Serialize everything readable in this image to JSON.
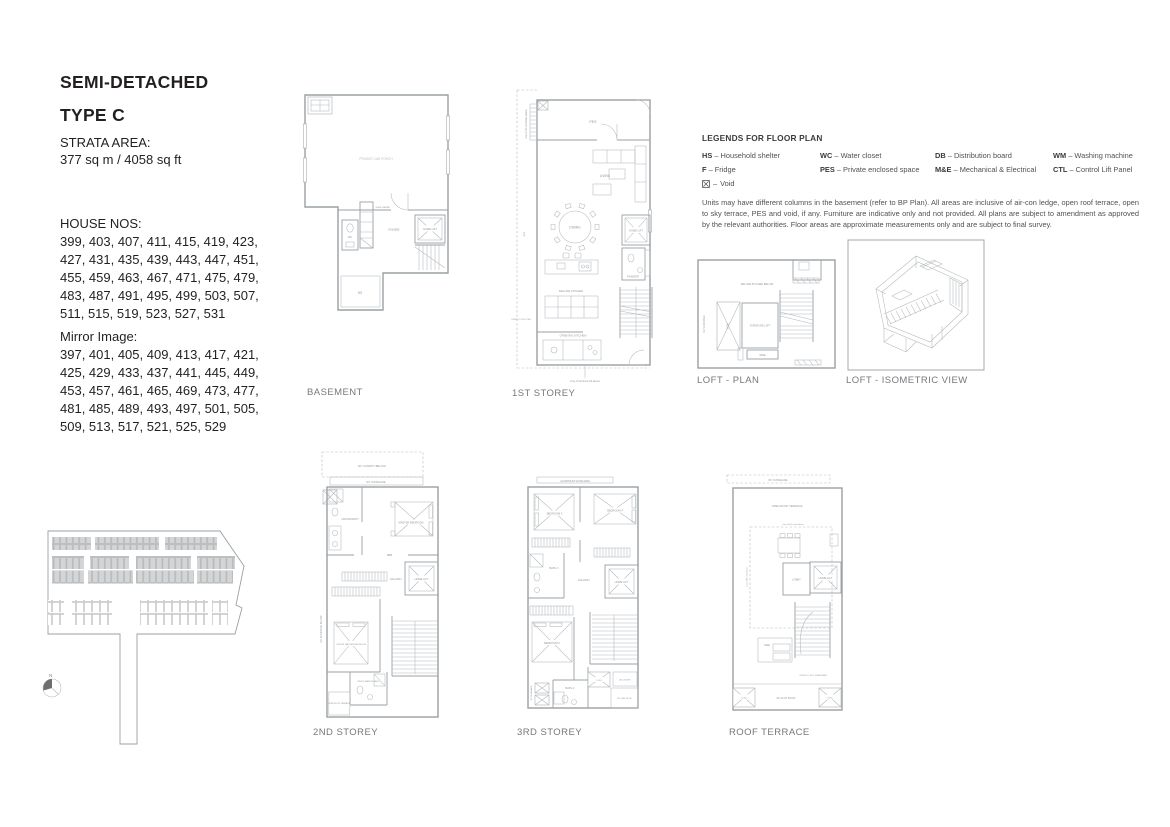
{
  "header": {
    "title_line1": "SEMI-DETACHED",
    "title_line2": "TYPE C",
    "strata_label": "STRATA AREA:",
    "strata_value": "377 sq m / 4058 sq ft",
    "house_nos_label": "HOUSE NOS:",
    "house_nos": "399, 403, 407, 411, 415, 419, 423,\n427, 431, 435, 439, 443, 447, 451,\n455, 459, 463, 467, 471, 475, 479,\n483, 487, 491, 495, 499, 503, 507,\n511, 515, 519, 523, 527, 531",
    "mirror_label": "Mirror Image:",
    "mirror_nos": "397, 401, 405, 409, 413, 417, 421,\n425, 429, 433, 437, 441, 445, 449,\n453, 457, 461, 465, 469, 473, 477,\n481, 485, 489, 493, 497, 501, 505,\n509, 513, 517, 521, 525, 529"
  },
  "legend": {
    "title": "LEGENDS FOR FLOOR PLAN",
    "dash": "–",
    "items": [
      {
        "abbr": "HS",
        "desc": "Household shelter"
      },
      {
        "abbr": "WC",
        "desc": "Water closet"
      },
      {
        "abbr": "DB",
        "desc": "Distribution board"
      },
      {
        "abbr": "WM",
        "desc": "Washing machine"
      },
      {
        "abbr": "F",
        "desc": "Fridge"
      },
      {
        "abbr": "PES",
        "desc": "Private enclosed space"
      },
      {
        "abbr": "M&E",
        "desc": "Mechanical & Electrical"
      },
      {
        "abbr": "CTL",
        "desc": "Control Lift Panel"
      },
      {
        "abbr": "",
        "desc": "Void"
      }
    ],
    "disclaimer": "Units may have different columns in the basement (refer to BP Plan). All areas are inclusive of air-con ledge, open roof terrace, open to sky terrace, PES and void, if any. Furniture are indicative only and not provided. All plans are subject to amendment as approved by the relevant authorities. Floor areas are approximate measurements only and are subject to final survey."
  },
  "plans": {
    "basement": {
      "title": "BASEMENT",
      "labels": {
        "car_porch": "PRIVATE CAR PORCH",
        "foyer": "FOYER",
        "home_lift": "HOME LIFT",
        "wc": "WC",
        "hs": "HS",
        "shoe": "SHOE CABINET"
      }
    },
    "first": {
      "title": "1ST STOREY",
      "labels": {
        "pes": "PES",
        "pes_side": "PES",
        "living": "LIVING",
        "dining": "DINING",
        "home_lift": "HOME LIFT",
        "powder": "POWDER",
        "deluxe_kitchen": "DELUXE KITCHEN",
        "oriental_kitchen": "ORIENTAL KITCHEN",
        "sunshade_note": "Line of RC sunshade above",
        "open_sky": "OPEN TO SKY PES",
        "furniture_note": "Line of furniture loft above"
      }
    },
    "loft_plan": {
      "title": "LOFT - PLAN",
      "labels": {
        "kitchen_below": "DELUXE KITCHEN BELOW",
        "void": "VOID",
        "furniture_loft": "FURNITURE LOFT",
        "wine": "WINE",
        "sunshade": "RC SUNSHADE"
      }
    },
    "loft_iso": {
      "title": "LOFT - ISOMETRIC VIEW"
    },
    "second": {
      "title": "2ND STOREY",
      "labels": {
        "canopy": "RC CANOPY BELOW",
        "sunshade": "RC SUNSHADE",
        "sunshade_below": "RC SUNSHADE BELOW",
        "master_bath": "MASTER BATH",
        "master_bedroom": "MASTER BEDROOM",
        "hallway": "HALLWAY",
        "home_lift": "HOME LIFT",
        "junior_master_bedroom": "JUNIOR MASTER BEDROOM",
        "junior_master_bath": "JUNIOR MASTER BATH",
        "terrace": "OPEN ROOF TERRACE"
      }
    },
    "third": {
      "title": "3RD STOREY",
      "labels": {
        "sunshade": "ALUMINIUM SUNSHADE",
        "bedroom3": "BEDROOM 3",
        "bedroom4": "BEDROOM 4",
        "bath3": "BATH 3",
        "hallway": "HALLWAY",
        "home_lift": "HOME LIFT",
        "bedroom2": "BEDROOM 2",
        "bath2": "BATH 2",
        "void": "VOID",
        "ac_ledge": "AC LEDGE",
        "flat_roof": "RC FLAT ROOF",
        "rc_sunshade": "RC SUNSHADE"
      }
    },
    "roof": {
      "title": "ROOF TERRACE",
      "labels": {
        "sunshade": "RC SUNSHADE",
        "terrace": "OPEN ROOF TERRACE",
        "roof_line": "Line of RC roof above",
        "lobby": "LOBBY",
        "home_lift": "HOME LIFT",
        "mne": "M&E",
        "stair": "OPEN TO SKY STAIRCASE",
        "flat_roof": "RC FLAT ROOF",
        "void": "VOID"
      }
    }
  },
  "site_plan": {
    "north": "N"
  },
  "colors": {
    "text_primary": "#231f20",
    "title_gray": "#77787b",
    "plan_line": "#9aa0a4",
    "plan_thin": "#b3b7ba",
    "label_gray": "#94969a",
    "shaded_unit": "#d4d5d6"
  }
}
